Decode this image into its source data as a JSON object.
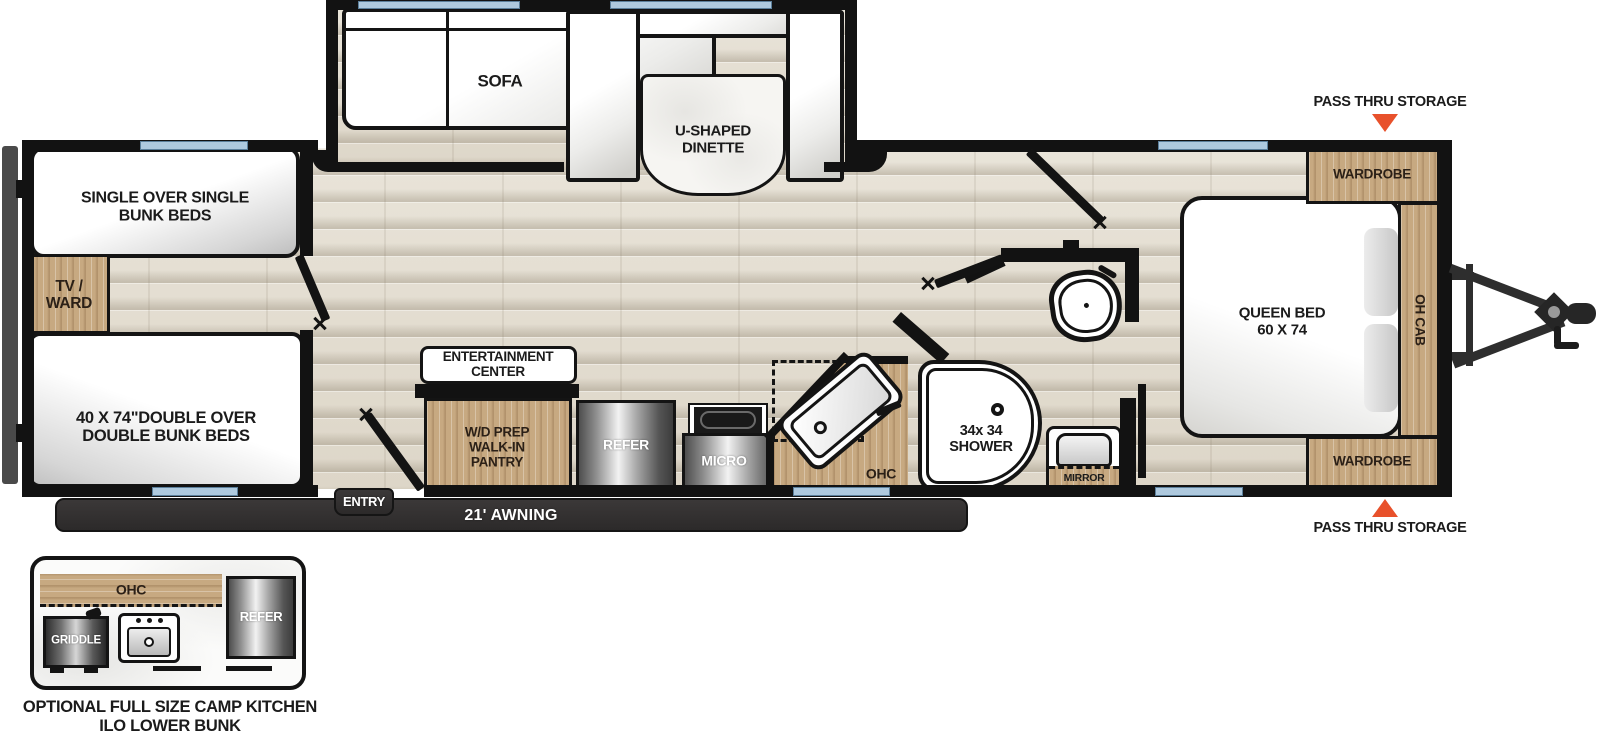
{
  "colors": {
    "accent_orange": "#E8512B",
    "window_blue": "#AEC9DE",
    "wood_tan": "#C7A981",
    "wall_black": "#121212",
    "awning_gray": "#3B3838"
  },
  "floorplan": {
    "annotations": {
      "pass_thru_top": "PASS THRU STORAGE",
      "pass_thru_bottom": "PASS THRU STORAGE"
    },
    "slideout": {
      "sofa": "SOFA",
      "dinette": "U-SHAPED\nDINETTE"
    },
    "rear": {
      "single_bunk": "SINGLE OVER SINGLE\nBUNK BEDS",
      "tv_ward": "TV /\nWARD",
      "double_bunk": "40 X 74\"DOUBLE OVER\nDOUBLE BUNK BEDS"
    },
    "kitchen": {
      "entertainment_center": "ENTERTAINMENT\nCENTER",
      "pantry": "W/D PREP\nWALK-IN\nPANTRY",
      "refer": "REFER",
      "micro": "MICRO",
      "ohc": "OHC"
    },
    "bath": {
      "shower": "34x 34\nSHOWER",
      "mirror": "MIRROR"
    },
    "bedroom": {
      "queen_bed": "QUEEN BED\n60 X 74",
      "wardrobe_top": "WARDROBE",
      "wardrobe_bottom": "WARDROBE",
      "oh_cab": "OH CAB"
    },
    "exterior": {
      "entry": "ENTRY",
      "awning": "21' AWNING"
    }
  },
  "inset": {
    "ohc": "OHC",
    "griddle": "GRIDDLE",
    "refer": "REFER",
    "caption": "OPTIONAL FULL SIZE CAMP KITCHEN\nILO LOWER BUNK"
  }
}
